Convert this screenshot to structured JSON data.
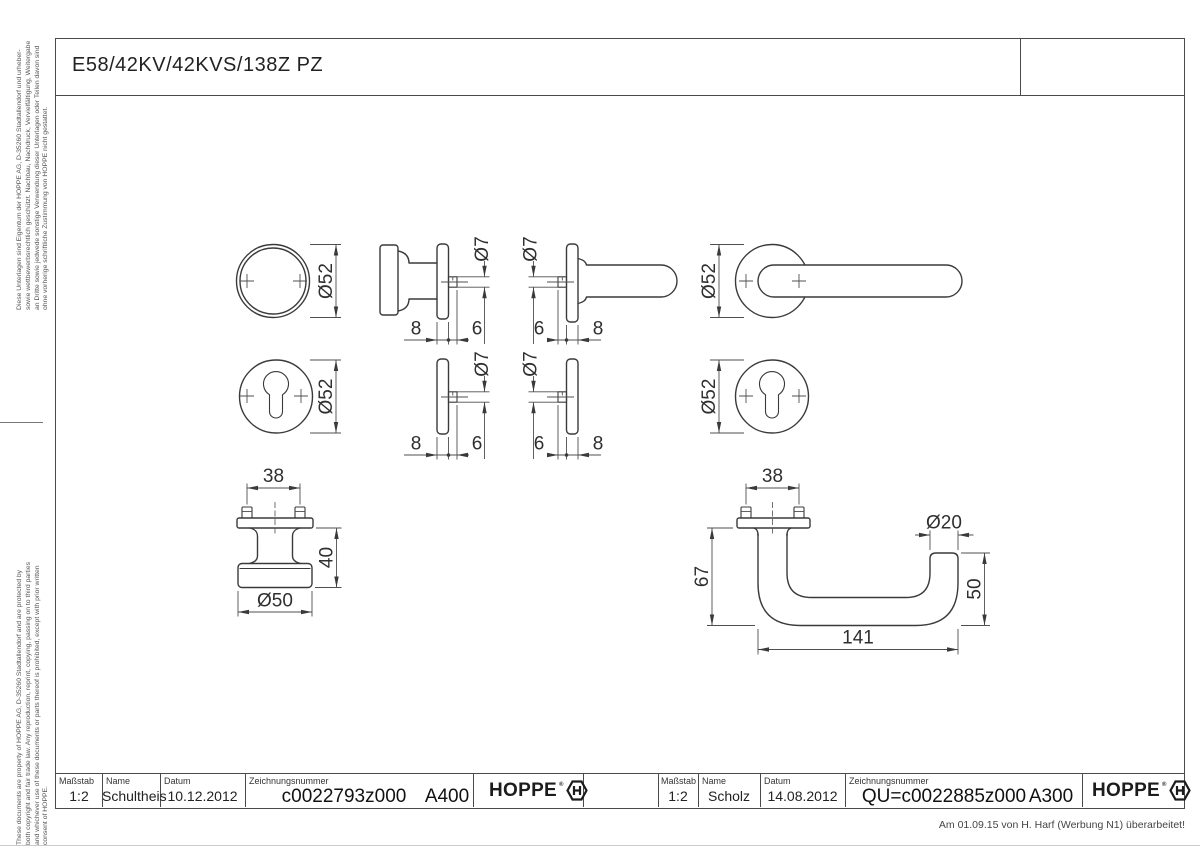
{
  "sheet": {
    "title": "E58/42KV/42KVS/138Z PZ",
    "revision_note": "Am 01.09.15 von H. Harf (Werbung N1) überarbeitet!",
    "disclaimer_de": "Diese Unterlagen sind Eigentum der HOPPE AG, D-35260 Stadtallendorf und urheber- sowie wettbewerbsrechtlich geschützt. Nachbau, Nachdruck, Vervielfältigung, Weitergabe an Dritte sowie jedwede sonstige Verwendung dieser Unterlagen oder Teilen davon sind ohne vorherige schriftliche Zustimmung von HOPPE nicht gestattet.",
    "disclaimer_en": "These documents are property of HOPPE AG, D-35260 Stadtallendorf and are protected by both copyright and fair trade law. Any reproduction, reprint, copying, passing on to third parties and whichever use of these documents or parts thereof is prohibited, except with prior written consent of HOPPE."
  },
  "title_block_left": {
    "scale_label": "Maßstab",
    "scale_value": "1:2",
    "name_label": "Name",
    "name_value": "Schultheis",
    "date_label": "Datum",
    "date_value": "10.12.2012",
    "drawing_no_label": "Zeichnungsnummer",
    "drawing_no_value": "c0022793z000",
    "revision_code": "A400"
  },
  "title_block_right": {
    "scale_label": "Maßstab",
    "scale_value": "1:2",
    "name_label": "Name",
    "name_value": "Scholz",
    "date_label": "Datum",
    "date_value": "14.08.2012",
    "drawing_no_label": "Zeichnungsnummer",
    "drawing_no_value": "QU=c0022885z000",
    "revision_code": "A300"
  },
  "logo": {
    "brand": "HOPPE",
    "registered": "®"
  },
  "dimensions": {
    "rose_diameter": "Ø52",
    "spindle_diameter": "Ø7",
    "rose_thickness": "8",
    "spindle_protrusion": "6",
    "screw_spacing": "38",
    "knob_projection": "40",
    "knob_diameter": "Ø50",
    "lever_drop": "67",
    "grip_diameter": "Ø20",
    "lever_end_offset": "50",
    "lever_length": "141"
  }
}
